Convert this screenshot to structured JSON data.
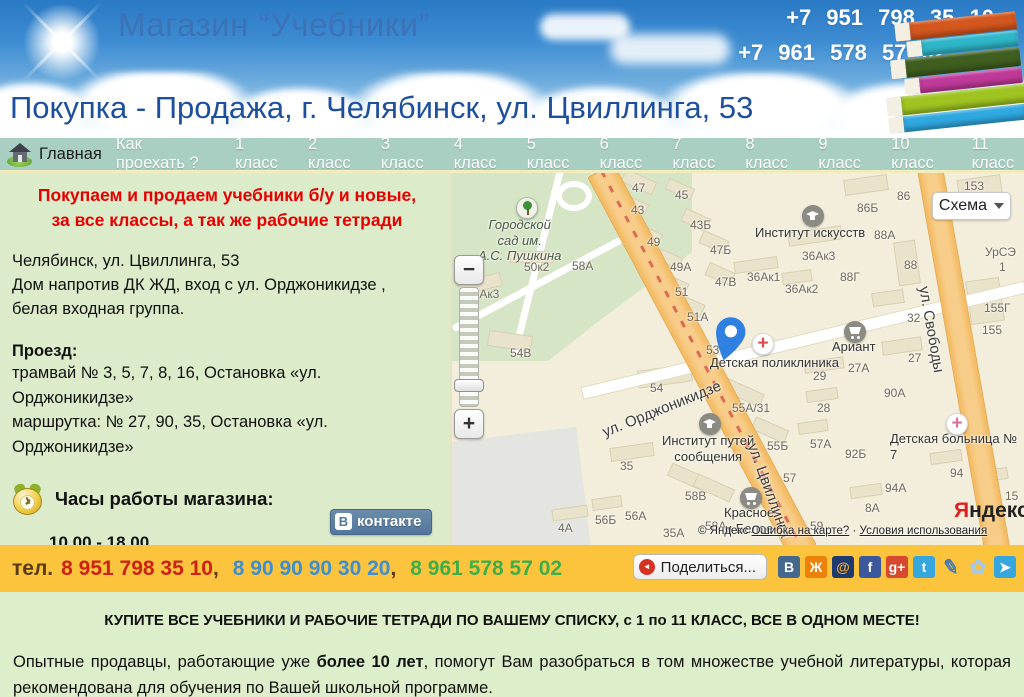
{
  "header": {
    "title": "Магазин “Учебники”",
    "phone1": "+7 951 798 35 10",
    "phone2": "+7 961 578 57 02",
    "subtitle": "Покупка - Продажа, г. Челябинск, ул. Цвиллинга, 53",
    "book_colors": [
      {
        "bg": "#d4571e"
      },
      {
        "bg": "#2fb6c9"
      },
      {
        "bg": "#3f5e1f"
      },
      {
        "bg": "#c03a9a"
      },
      {
        "bg": "#9fc421"
      },
      {
        "bg": "#2fa8e0"
      }
    ]
  },
  "nav": {
    "home": "Главная",
    "items": [
      {
        "label": "Как проехать ?"
      },
      {
        "label": "1 класс"
      },
      {
        "label": "2 класс"
      },
      {
        "label": "3 класс"
      },
      {
        "label": "4 класс"
      },
      {
        "label": "5 класс"
      },
      {
        "label": "6 класс"
      },
      {
        "label": "7 класс"
      },
      {
        "label": "8 класс"
      },
      {
        "label": "9 класс"
      },
      {
        "label": "10 класс"
      },
      {
        "label": "11 класс"
      }
    ]
  },
  "info": {
    "promo_line1": "Покупаем и продаем учебники б/у и новые,",
    "promo_line2": "за все классы,  а так же рабочие тетради",
    "address_lines": [
      {
        "t": "Челябинск, ул. Цвиллинга, 53"
      },
      {
        "t": "Дом напротив ДК ЖД, вход с ул. Орджоникидзе ,"
      },
      {
        "t": "белая входная группа."
      }
    ],
    "transit_title": "Проезд:",
    "transit_lines": [
      {
        "t": "трамвай № 3, 5, 7, 8, 16, Остановка «ул."
      },
      {
        "t": "Орджоникидзе»"
      },
      {
        "t": "маршрутка: № 27, 90, 35, Остановка «ул."
      },
      {
        "t": "Орджоникидзе»"
      }
    ],
    "hours_title": "Часы работы магазина:",
    "hours_value": "10.00 - 18.00",
    "hours_note": "без перерыва и выходных",
    "vk_icon": "В",
    "vk_label": "контакте"
  },
  "map": {
    "mode_button": "Схема",
    "zoom_in": "+",
    "zoom_out": "−",
    "logo_ya": "Я",
    "logo_rest": "ндекс",
    "copyright": "© Яндекс",
    "error_link": "Ошибка на карте?",
    "separator": "·",
    "terms_link": "Условия использования",
    "building_labels": [
      {
        "t": "47",
        "x": 180,
        "y": 8
      },
      {
        "t": "45",
        "x": 223,
        "y": 15
      },
      {
        "t": "43",
        "x": 179,
        "y": 30
      },
      {
        "t": "43Б",
        "x": 238,
        "y": 45
      },
      {
        "t": "49",
        "x": 195,
        "y": 62
      },
      {
        "t": "47Б",
        "x": 258,
        "y": 70
      },
      {
        "t": "49А",
        "x": 218,
        "y": 87
      },
      {
        "t": "47В",
        "x": 263,
        "y": 102
      },
      {
        "t": "51",
        "x": 223,
        "y": 112
      },
      {
        "t": "51А",
        "x": 235,
        "y": 137
      },
      {
        "t": "53",
        "x": 254,
        "y": 170
      },
      {
        "t": "50к2",
        "x": 72,
        "y": 87
      },
      {
        "t": "58А",
        "x": 120,
        "y": 86
      },
      {
        "t": "58Ак3",
        "x": 14,
        "y": 114
      },
      {
        "t": "54В",
        "x": 58,
        "y": 173
      },
      {
        "t": "153",
        "x": 512,
        "y": 6
      },
      {
        "t": "86",
        "x": 445,
        "y": 16
      },
      {
        "t": "86Б",
        "x": 405,
        "y": 28
      },
      {
        "t": "88А",
        "x": 422,
        "y": 55
      },
      {
        "t": "36Ак3",
        "x": 350,
        "y": 76
      },
      {
        "t": "36Ак1",
        "x": 295,
        "y": 97
      },
      {
        "t": "36Ак2",
        "x": 333,
        "y": 109
      },
      {
        "t": "88Г",
        "x": 388,
        "y": 97
      },
      {
        "t": "88",
        "x": 452,
        "y": 85
      },
      {
        "t": "1",
        "x": 542,
        "y": 20
      },
      {
        "t": "УрСЭ",
        "x": 533,
        "y": 72
      },
      {
        "t": "1",
        "x": 547,
        "y": 87
      },
      {
        "t": "155Г",
        "x": 532,
        "y": 128
      },
      {
        "t": "155",
        "x": 530,
        "y": 150
      },
      {
        "t": "32",
        "x": 455,
        "y": 138
      },
      {
        "t": "27",
        "x": 456,
        "y": 178
      },
      {
        "t": "27А",
        "x": 396,
        "y": 188
      },
      {
        "t": "29",
        "x": 361,
        "y": 196
      },
      {
        "t": "54",
        "x": 198,
        "y": 208
      },
      {
        "t": "55А/31",
        "x": 280,
        "y": 228
      },
      {
        "t": "28",
        "x": 365,
        "y": 228
      },
      {
        "t": "55Б",
        "x": 315,
        "y": 266
      },
      {
        "t": "57А",
        "x": 358,
        "y": 264
      },
      {
        "t": "92Б",
        "x": 393,
        "y": 274
      },
      {
        "t": "90А",
        "x": 432,
        "y": 213
      },
      {
        "t": "35",
        "x": 168,
        "y": 286
      },
      {
        "t": "58В",
        "x": 233,
        "y": 316
      },
      {
        "t": "57",
        "x": 331,
        "y": 298
      },
      {
        "t": "56А",
        "x": 173,
        "y": 336
      },
      {
        "t": "58А",
        "x": 253,
        "y": 346
      },
      {
        "t": "35А",
        "x": 211,
        "y": 353
      },
      {
        "t": "59",
        "x": 358,
        "y": 346
      },
      {
        "t": "8А",
        "x": 413,
        "y": 328
      },
      {
        "t": "94А",
        "x": 433,
        "y": 308
      },
      {
        "t": "94",
        "x": 498,
        "y": 293
      },
      {
        "t": "15",
        "x": 553,
        "y": 316
      },
      {
        "t": "4А",
        "x": 106,
        "y": 348
      },
      {
        "t": "56Б",
        "x": 143,
        "y": 340
      }
    ],
    "poi_labels": [
      {
        "t": "Городской\nсад им.\nА.С. Пушкина",
        "x": 26,
        "y": 44,
        "cls": "center italic"
      },
      {
        "t": "Институт искусств",
        "x": 303,
        "y": 52
      },
      {
        "t": "Ариант",
        "x": 380,
        "y": 166
      },
      {
        "t": "Детская поликлиника",
        "x": 258,
        "y": 182
      },
      {
        "t": "Институт путей\nсообщения",
        "x": 210,
        "y": 260,
        "cls": "center"
      },
      {
        "t": "Детская больница № 7",
        "x": 438,
        "y": 258
      },
      {
        "t": "Красное\nи Белое",
        "x": 272,
        "y": 332,
        "cls": "center"
      }
    ],
    "street_labels": [
      {
        "t": "ул. Орджоникидзе",
        "x": 148,
        "y": 252,
        "rot": -22
      },
      {
        "t": "ул. Свободы",
        "x": 480,
        "y": 112,
        "rot": 80
      },
      {
        "t": "ул. Цвиллинга",
        "x": 308,
        "y": 268,
        "rot": 70
      }
    ],
    "pois": [
      {
        "cls": "poi-tree",
        "x": 64,
        "y": 24
      },
      {
        "cls": "poi-cap",
        "x": 350,
        "y": 32
      },
      {
        "cls": "poi-cap",
        "x": 247,
        "y": 240
      },
      {
        "cls": "poi-cart",
        "x": 392,
        "y": 148
      },
      {
        "cls": "poi-cart",
        "x": 288,
        "y": 314
      },
      {
        "cls": "poi-cross cross-red",
        "glyph": "+",
        "x": 300,
        "y": 160
      },
      {
        "cls": "poi-cross cross-pink",
        "glyph": "+",
        "x": 494,
        "y": 240
      }
    ],
    "blocks": [
      {
        "x": 170,
        "y": 2,
        "w": 34,
        "h": 14,
        "rot": 24
      },
      {
        "x": 214,
        "y": 10,
        "w": 28,
        "h": 12,
        "rot": 24
      },
      {
        "x": 170,
        "y": 26,
        "w": 26,
        "h": 12,
        "rot": 24
      },
      {
        "x": 230,
        "y": 40,
        "w": 28,
        "h": 14,
        "rot": 24
      },
      {
        "x": 186,
        "y": 56,
        "w": 24,
        "h": 12,
        "rot": 24
      },
      {
        "x": 248,
        "y": 62,
        "w": 28,
        "h": 14,
        "rot": 24
      },
      {
        "x": 206,
        "y": 80,
        "w": 24,
        "h": 12,
        "rot": 24
      },
      {
        "x": 254,
        "y": 94,
        "w": 28,
        "h": 14,
        "rot": 24
      },
      {
        "x": 214,
        "y": 106,
        "w": 22,
        "h": 12,
        "rot": 24
      },
      {
        "x": 224,
        "y": 126,
        "w": 28,
        "h": 14,
        "rot": 24
      },
      {
        "x": 58,
        "y": 78,
        "w": 44,
        "h": 12,
        "rot": 0
      },
      {
        "x": 6,
        "y": 104,
        "w": 44,
        "h": 14,
        "rot": -14
      },
      {
        "x": 36,
        "y": 160,
        "w": 44,
        "h": 16,
        "rot": 8
      },
      {
        "x": 392,
        "y": 4,
        "w": 44,
        "h": 16,
        "rot": -8
      },
      {
        "x": 336,
        "y": 56,
        "w": 54,
        "h": 14,
        "rot": -8
      },
      {
        "x": 282,
        "y": 86,
        "w": 44,
        "h": 12,
        "rot": -8
      },
      {
        "x": 330,
        "y": 98,
        "w": 30,
        "h": 12,
        "rot": -8
      },
      {
        "x": 444,
        "y": 68,
        "w": 22,
        "h": 44,
        "rot": -8
      },
      {
        "x": 420,
        "y": 118,
        "w": 32,
        "h": 14,
        "rot": -8
      },
      {
        "x": 430,
        "y": 166,
        "w": 40,
        "h": 14,
        "rot": -8
      },
      {
        "x": 352,
        "y": 186,
        "w": 40,
        "h": 12,
        "rot": -8
      },
      {
        "x": 186,
        "y": 194,
        "w": 54,
        "h": 18,
        "rot": -8
      },
      {
        "x": 268,
        "y": 212,
        "w": 44,
        "h": 14,
        "rot": 24
      },
      {
        "x": 354,
        "y": 216,
        "w": 32,
        "h": 12,
        "rot": -8
      },
      {
        "x": 300,
        "y": 250,
        "w": 36,
        "h": 14,
        "rot": 24
      },
      {
        "x": 346,
        "y": 248,
        "w": 30,
        "h": 12,
        "rot": -8
      },
      {
        "x": 158,
        "y": 272,
        "w": 44,
        "h": 14,
        "rot": -8
      },
      {
        "x": 216,
        "y": 298,
        "w": 44,
        "h": 14,
        "rot": 24
      },
      {
        "x": 398,
        "y": 312,
        "w": 32,
        "h": 12,
        "rot": -8
      },
      {
        "x": 478,
        "y": 278,
        "w": 32,
        "h": 12,
        "rot": -8
      },
      {
        "x": 524,
        "y": 296,
        "w": 32,
        "h": 12,
        "rot": -8
      },
      {
        "x": 516,
        "y": 106,
        "w": 34,
        "h": 44,
        "rot": -8
      },
      {
        "x": 506,
        "y": 4,
        "w": 44,
        "h": 26,
        "rot": -8
      },
      {
        "x": 242,
        "y": 308,
        "w": 40,
        "h": 14,
        "rot": 24
      },
      {
        "x": 100,
        "y": 334,
        "w": 36,
        "h": 12,
        "rot": -8
      },
      {
        "x": 140,
        "y": 324,
        "w": 30,
        "h": 12,
        "rot": -8
      }
    ]
  },
  "phonebar": {
    "label": "тел.",
    "phone1": "8 951 798 35 10",
    "phone2": "8 90 90 90 30 20",
    "phone3": "8 961 578 57 02",
    "comma": ",",
    "colors": {
      "phone1": "#cc2211",
      "phone2": "#3e8ed0",
      "phone3": "#3fae49",
      "bar": "#fbc43c"
    }
  },
  "share": {
    "button_label": "Поделиться...",
    "icon_glyph": "◄",
    "icons": [
      {
        "name": "vk",
        "glyph": "В",
        "bg": "#45688e",
        "fg": "#ffffff"
      },
      {
        "name": "odnoklassniki",
        "glyph": "Ж",
        "bg": "#ee8208",
        "fg": "#ffffff"
      },
      {
        "name": "moy-mir",
        "glyph": "@",
        "bg": "#1e3a6e",
        "fg": "#f5a623"
      },
      {
        "name": "facebook",
        "glyph": "f",
        "bg": "#3a589b",
        "fg": "#ffffff"
      },
      {
        "name": "google-plus",
        "glyph": "g+",
        "bg": "#d6492f",
        "fg": "#ffffff"
      },
      {
        "name": "twitter",
        "glyph": "t",
        "bg": "#35a6de",
        "fg": "#ffffff"
      },
      {
        "name": "livejournal",
        "glyph": "✎",
        "bg": "transparent",
        "fg": "#4a78b0",
        "cls": "social-lj"
      },
      {
        "name": "flower",
        "glyph": "✿",
        "bg": "transparent",
        "fg": "#a8c8e8",
        "cls": "social-flower"
      },
      {
        "name": "ya-ru",
        "glyph": "➤",
        "bg": "#35a6de",
        "fg": "#ffffff"
      }
    ]
  },
  "bottom": {
    "headline": "КУПИТЕ ВСЕ УЧЕБНИКИ И РАБОЧИЕ ТЕТРАДИ ПО ВАШЕМУ СПИСКУ, с 1 по 11 КЛАСС, ВСЕ В ОДНОМ МЕСТЕ!",
    "para_before": "Опытные продавцы, работающие уже ",
    "para_bold": "более 10 лет",
    "para_after": ", помогут Вам разобраться в том множестве учебной литературы, которая рекомендована для обучения по Вашей школьной программе."
  }
}
